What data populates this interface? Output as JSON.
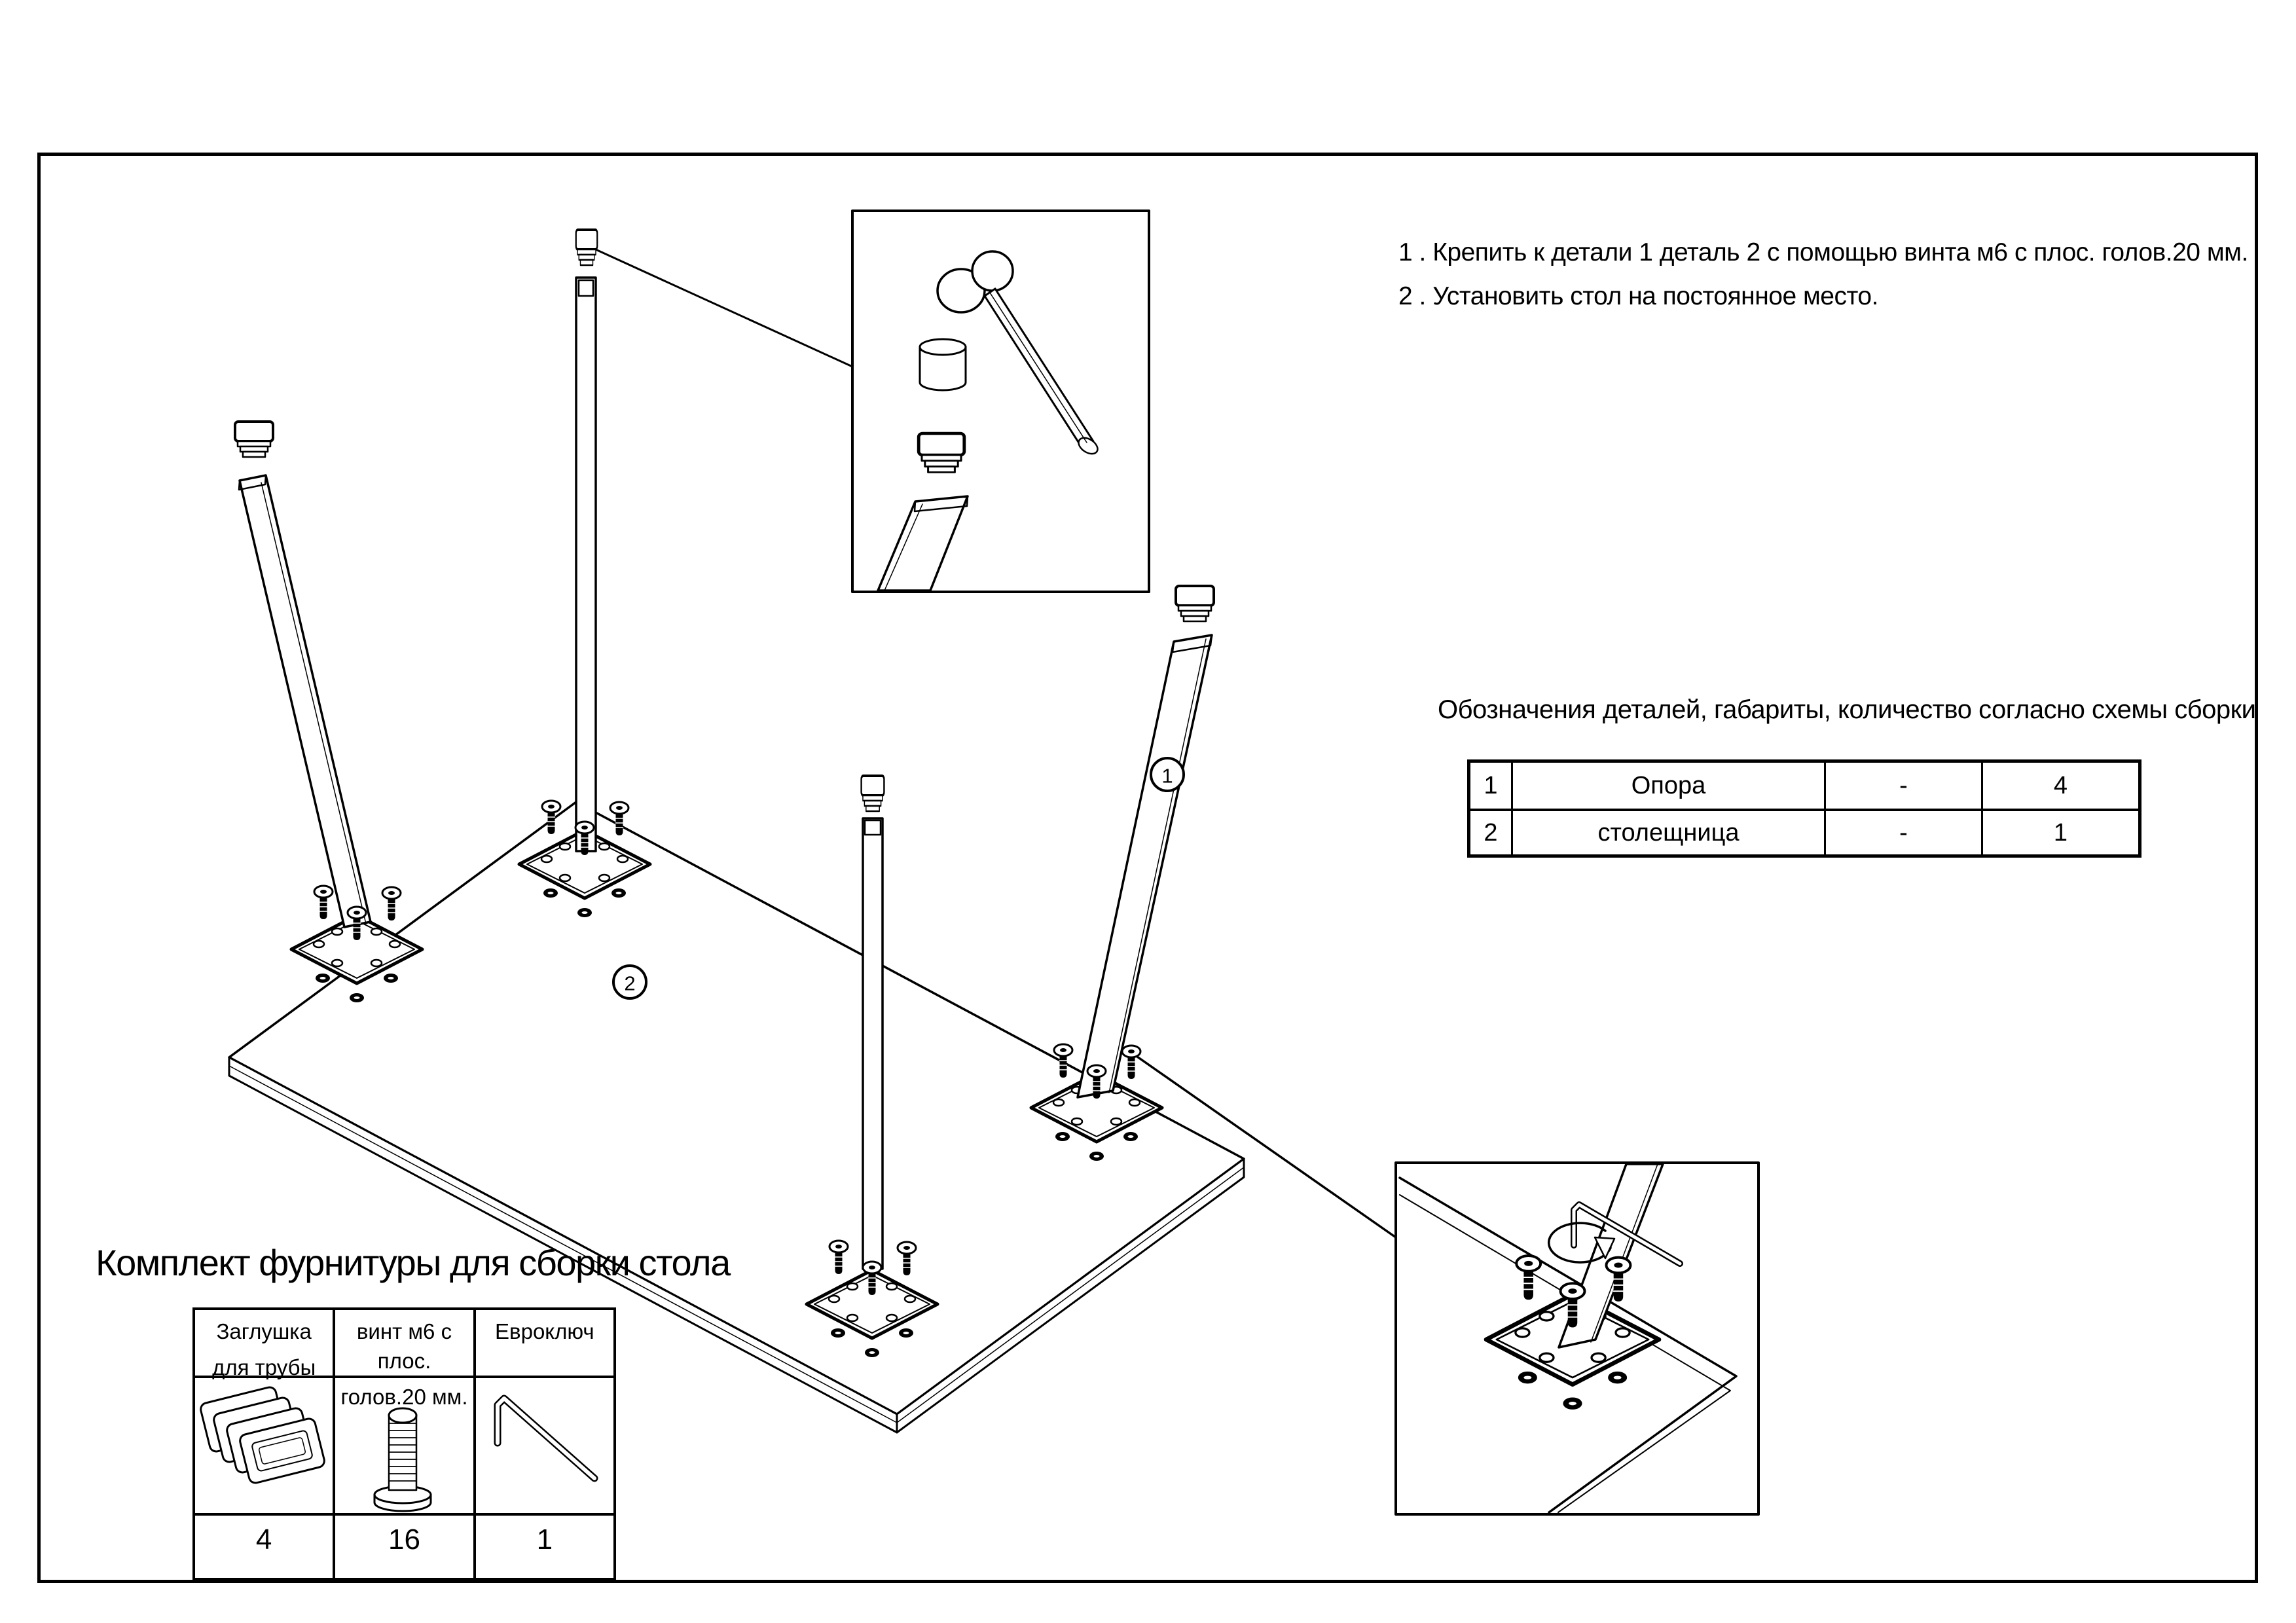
{
  "page": {
    "background": "#ffffff",
    "line_color": "#000000"
  },
  "instructions": {
    "line1": "1 . Крепить к детали 1 деталь 2 с помощью винта м6 с плос. голов.20 мм.",
    "line2": "2 . Установить стол на постоянное место."
  },
  "parts_table": {
    "title": "Обозначения деталей, габариты, количество согласно схемы сборки",
    "rows": [
      [
        "1",
        "Опора",
        "-",
        "4"
      ],
      [
        "2",
        "столещница",
        "-",
        "1"
      ]
    ]
  },
  "hardware_kit": {
    "title": "Комплект фурнитуры для сборки стола",
    "items": [
      {
        "icon": "pipe-cap-icon",
        "label": [
          "Заглушка",
          "для трубы"
        ],
        "qty": "4"
      },
      {
        "icon": "screw-icon",
        "label": [
          "винт м6 с плос.",
          "голов.20 мм."
        ],
        "qty": "16"
      },
      {
        "icon": "hex-key-icon",
        "label": [
          "Евроключ",
          ""
        ],
        "qty": "1"
      }
    ]
  },
  "callouts": {
    "support_leg": "1",
    "tabletop": "2"
  }
}
